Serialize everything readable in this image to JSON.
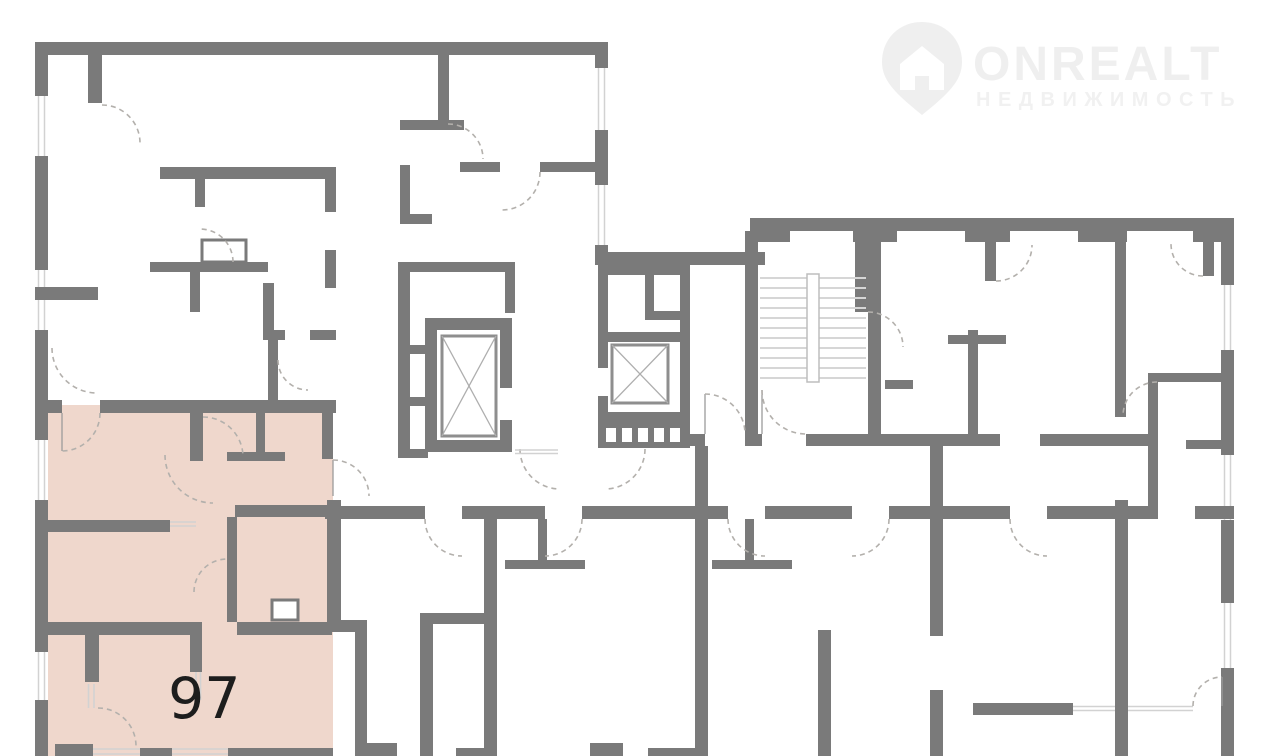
{
  "watermark": {
    "brand": "ONREALT",
    "subtitle": "НЕДВИЖИМОСТЬ",
    "icon": "house-pin-icon"
  },
  "unit": {
    "number": "97"
  },
  "palette": {
    "background": "#ffffff",
    "wall": "#7a7a7a",
    "unit_highlight": "#efd7cc",
    "unit_label": "#1d1d1d",
    "door_arc": "#b3b0ac",
    "window_line": "#d2d2d2",
    "stair_line": "#d6d6d6",
    "elevator_border": "#8e8e8e",
    "elevator_cross": "#aeaeae",
    "watermark_text": "#efefef",
    "watermark_subtext": "#f1f1f1"
  }
}
